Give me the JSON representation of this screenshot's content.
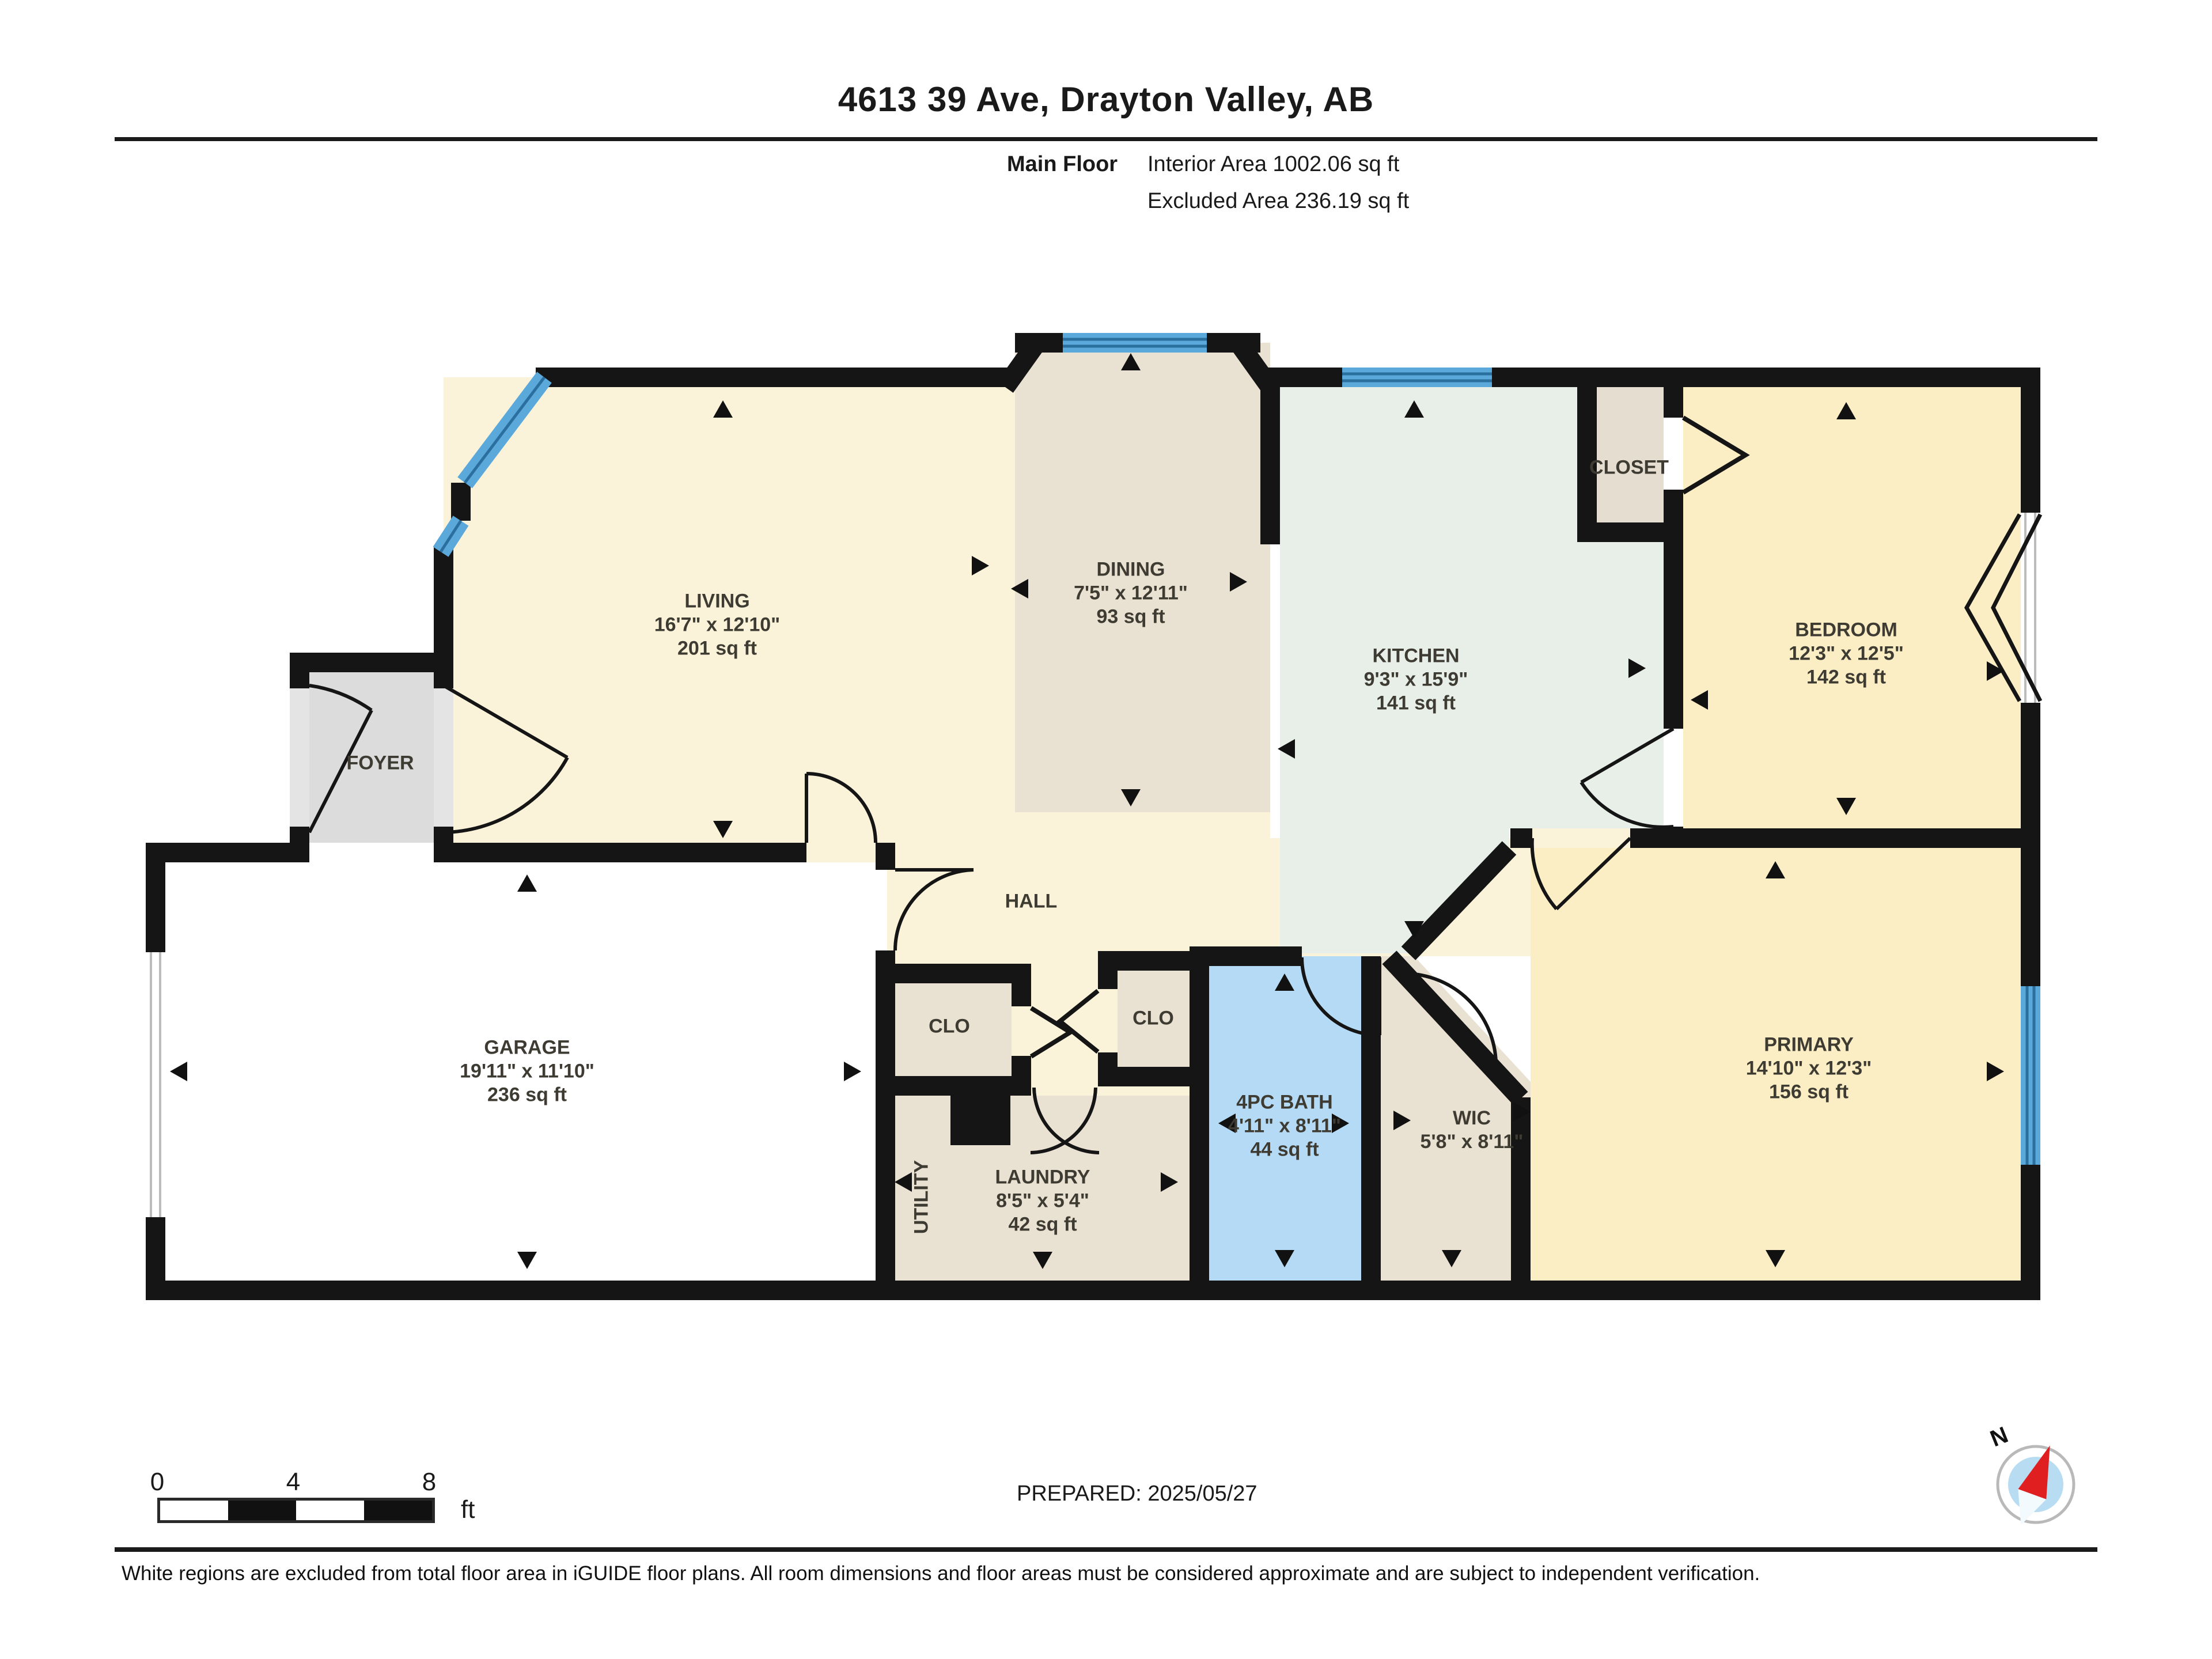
{
  "header": {
    "title": "4613 39 Ave, Drayton Valley, AB",
    "floor_label": "Main Floor",
    "interior_area": "Interior Area 1002.06 sq ft",
    "excluded_area": "Excluded Area 236.19 sq ft"
  },
  "rooms": {
    "living": {
      "name": "LIVING",
      "dims": "16'7\" x 12'10\"",
      "area": "201 sq ft"
    },
    "dining": {
      "name": "DINING",
      "dims": "7'5\" x 12'11\"",
      "area": "93 sq ft"
    },
    "kitchen": {
      "name": "KITCHEN",
      "dims": "9'3\" x 15'9\"",
      "area": "141 sq ft"
    },
    "bedroom": {
      "name": "BEDROOM",
      "dims": "12'3\" x 12'5\"",
      "area": "142 sq ft"
    },
    "closet": {
      "name": "CLOSET"
    },
    "foyer": {
      "name": "FOYER"
    },
    "garage": {
      "name": "GARAGE",
      "dims": "19'11\" x 11'10\"",
      "area": "236 sq ft"
    },
    "hall": {
      "name": "HALL"
    },
    "clo_left": {
      "name": "CLO"
    },
    "clo_right": {
      "name": "CLO"
    },
    "laundry": {
      "name": "LAUNDRY",
      "dims": "8'5\" x 5'4\"",
      "area": "42 sq ft"
    },
    "utility": {
      "name": "UTILITY"
    },
    "bath": {
      "name": "4PC BATH",
      "dims": "4'11\" x 8'11\"",
      "area": "44 sq ft"
    },
    "wic": {
      "name": "WIC",
      "dims": "5'8\" x 8'11\""
    },
    "primary": {
      "name": "PRIMARY",
      "dims": "14'10\" x 12'3\"",
      "area": "156 sq ft"
    }
  },
  "scale_bar": {
    "ticks": [
      "0",
      "4",
      "8"
    ],
    "unit": "ft"
  },
  "compass": {
    "label": "N"
  },
  "footer": {
    "prepared": "PREPARED: 2025/05/27",
    "disclaimer": "White regions are excluded from total floor area in iGUIDE floor plans. All room dimensions and floor areas must be considered approximate and are subject to independent verification."
  },
  "colors": {
    "wall": "#151515",
    "cream": "#faf3da",
    "tan": "#e9e1d1",
    "mint": "#e7efe8",
    "yellow": "#fbeec5",
    "bath_blue": "#b5daf5",
    "foyer_gray": "#dcdcdc",
    "window_blue": "#5ba8da",
    "compass_red": "#e02020"
  }
}
